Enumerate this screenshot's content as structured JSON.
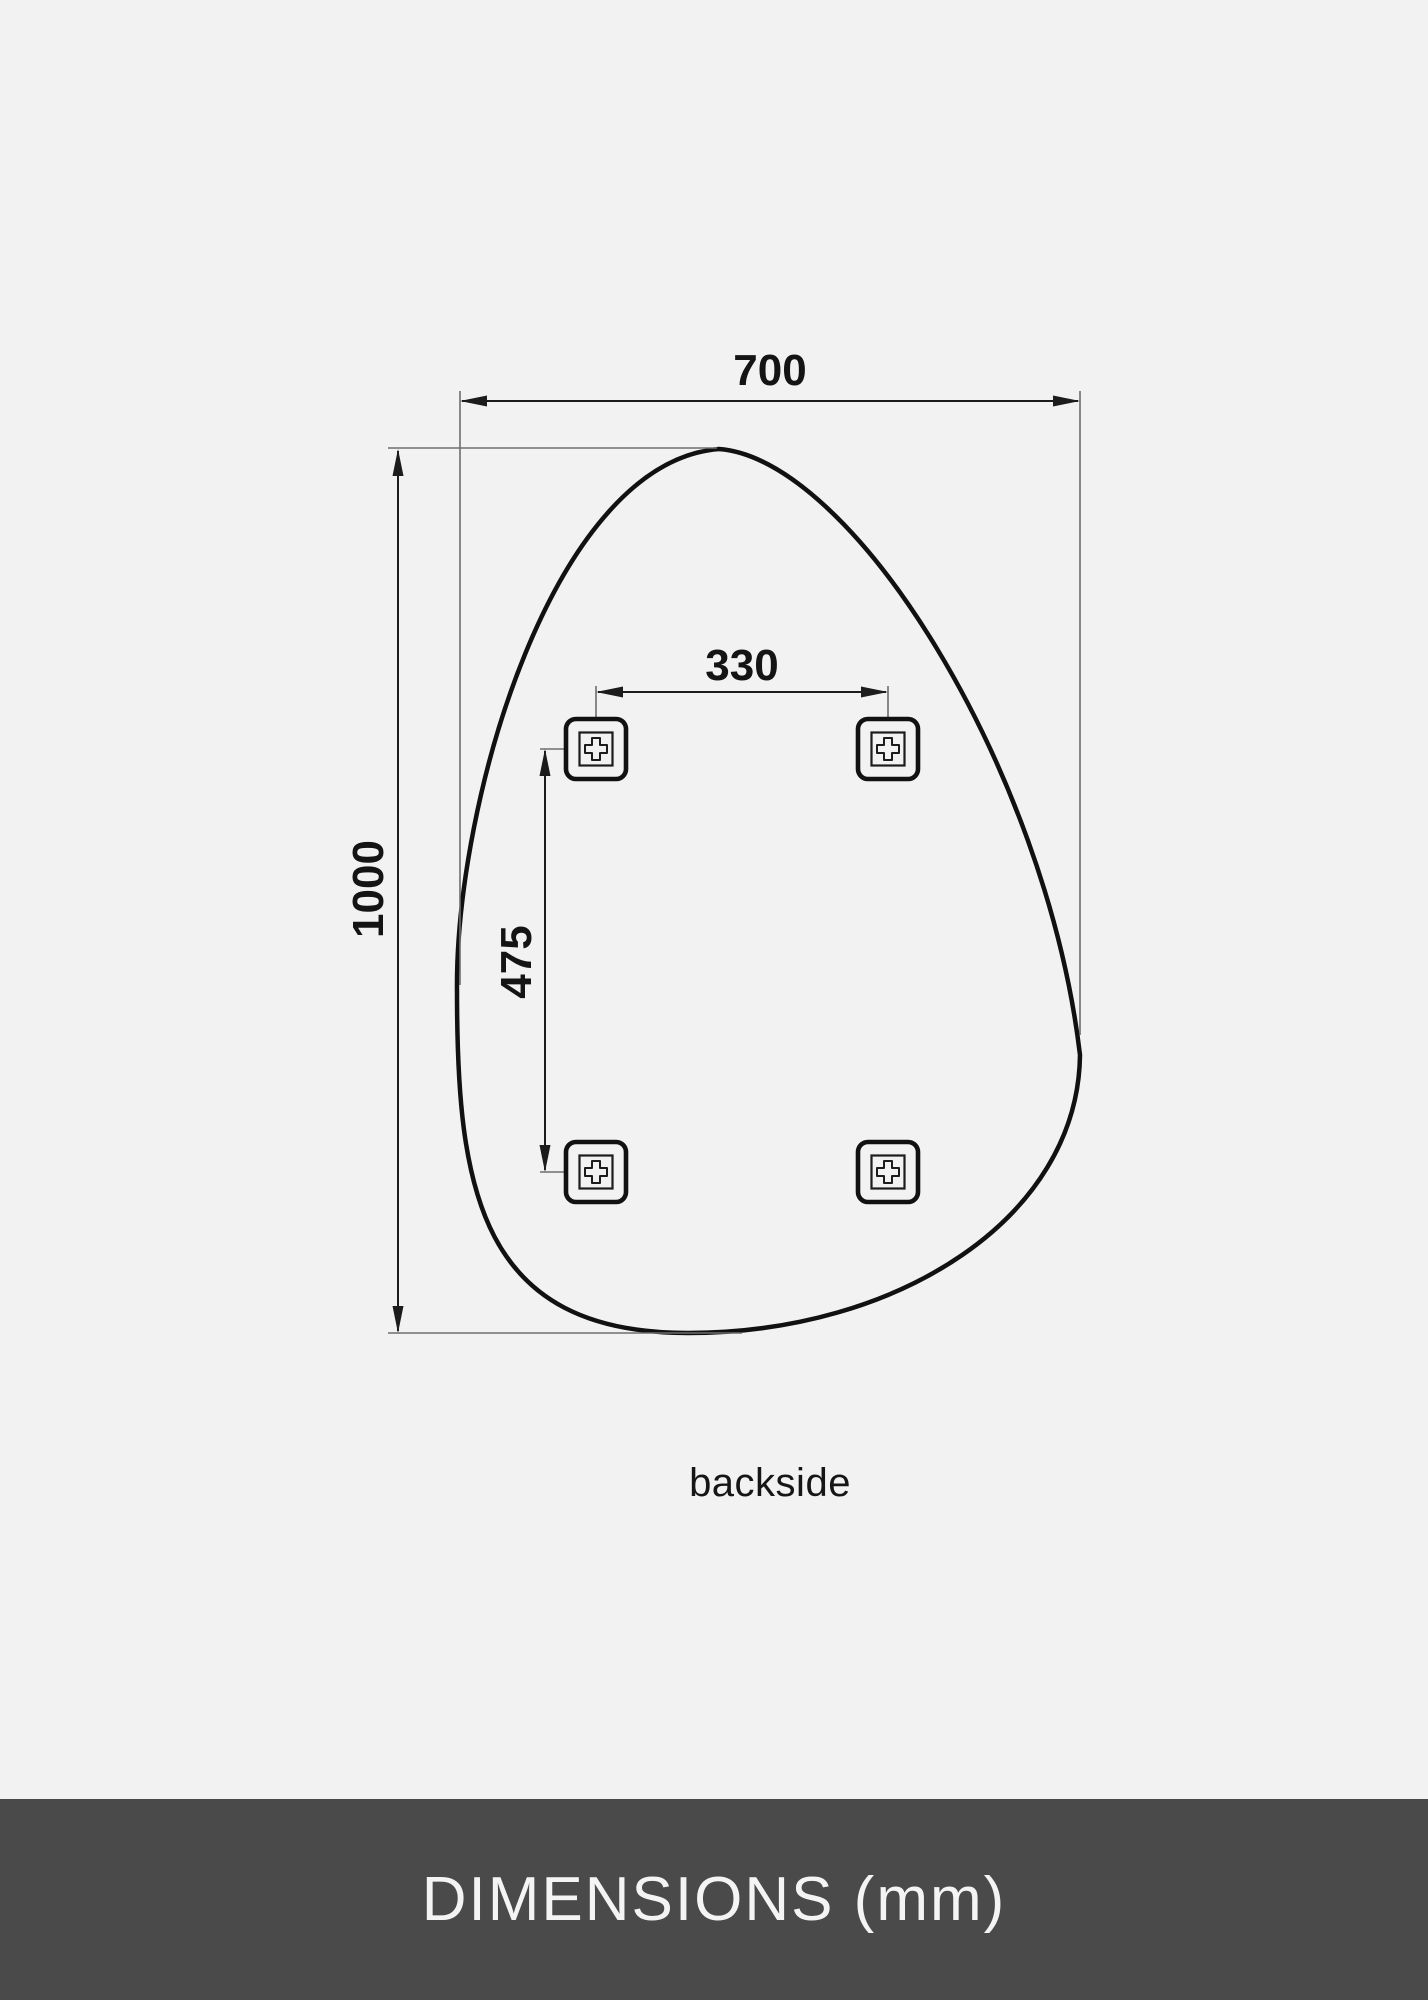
{
  "diagram": {
    "view_label": "backside",
    "dimensions": {
      "width_mm": "700",
      "height_mm": "1000",
      "bracket_spacing_horizontal_mm": "330",
      "bracket_spacing_vertical_mm": "475"
    },
    "bracket_count": 4
  },
  "footer": {
    "title": "DIMENSIONS (mm)"
  },
  "colors": {
    "background": "#f2f2f2",
    "outline": "#111111",
    "dimension_line": "#1c1c1c",
    "extension_line": "#6e6e6e",
    "footer_background": "#4a4a4a",
    "footer_text": "#f4f4f4"
  }
}
